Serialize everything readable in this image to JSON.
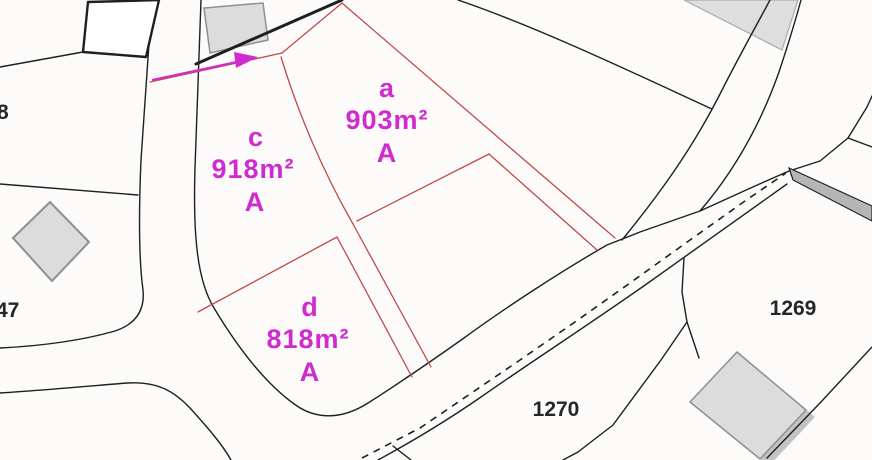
{
  "colors": {
    "background": "#fcfbf9",
    "line": "#1f1f1f",
    "red": "#c04a4a",
    "magenta": "#cf2bcf",
    "building_fill": "#dcdcdc",
    "building_shadow": "#c3c3c3",
    "building_stroke": "#8f8f8f",
    "band_fill": "#b5b5b5",
    "gray_area": "#dedede",
    "gray_area_stroke": "#ababab",
    "label_dark": "#262626"
  },
  "parcels": [
    {
      "letter": "a",
      "area": "903m²",
      "class": "A"
    },
    {
      "letter": "c",
      "area": "918m²",
      "class": "A"
    },
    {
      "letter": "d",
      "area": "818m²",
      "class": "A"
    }
  ],
  "parcel_numbers": {
    "left_top": "8",
    "left_bottom": "47",
    "right": "1269",
    "bottom": "1270"
  }
}
